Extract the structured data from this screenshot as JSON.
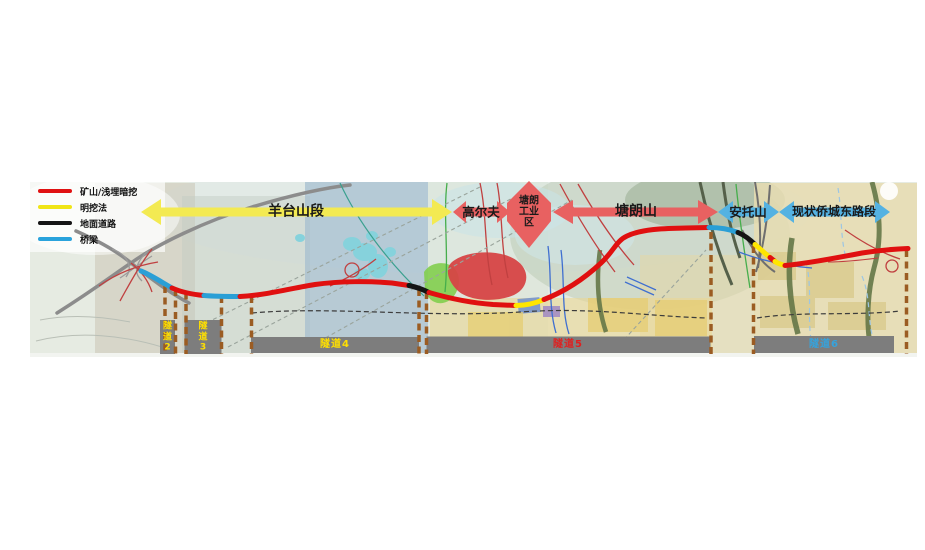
{
  "legend": {
    "items": [
      {
        "id": "mining",
        "label": "矿山/浅埋暗挖",
        "color": "#e01212"
      },
      {
        "id": "opencut",
        "label": "明挖法",
        "color": "#f0e516"
      },
      {
        "id": "ground",
        "label": "地面道路",
        "color": "#141414"
      },
      {
        "id": "bridge",
        "label": "桥梁",
        "color": "#2aa3dc"
      }
    ]
  },
  "sections": [
    {
      "id": "yangtaishan",
      "label": "羊台山段",
      "arrow_color": "#f3ea52",
      "shape": "double-arrow"
    },
    {
      "id": "golf",
      "label": "高尔夫",
      "arrow_color": "#e86161",
      "shape": "double-arrow"
    },
    {
      "id": "tanglang-industrial",
      "lines": [
        "塘朗",
        "工业",
        "区"
      ],
      "arrow_color": "#e86161",
      "shape": "diamond"
    },
    {
      "id": "tanglangshan",
      "label": "塘朗山",
      "arrow_color": "#e86161",
      "shape": "double-arrow"
    },
    {
      "id": "antuoshan",
      "label": "安托山",
      "arrow_color": "#54b2e2",
      "shape": "double-arrow"
    },
    {
      "id": "qiaocheng-east-road",
      "label": "现状侨城东路段",
      "arrow_color": "#54b2e2",
      "shape": "double-arrow"
    }
  ],
  "tunnels": [
    {
      "id": "tunnel-2",
      "label": "隧道2",
      "text_color": "#ffe000"
    },
    {
      "id": "tunnel-3",
      "label": "隧道3",
      "text_color": "#ffe000"
    },
    {
      "id": "tunnel-4",
      "label": "隧道4",
      "text_color": "#ffe000"
    },
    {
      "id": "tunnel-5",
      "label": "隧道5",
      "text_color": "#e02020"
    },
    {
      "id": "tunnel-6",
      "label": "隧道6",
      "text_color": "#35a3dd"
    }
  ],
  "route": {
    "segment_types": [
      "bridge",
      "mining",
      "bridge",
      "mining",
      "ground",
      "mining",
      "opencut",
      "mining",
      "bridge",
      "ground",
      "opencut",
      "mining",
      "opencut",
      "mining"
    ],
    "colors": {
      "mining": "#e01010",
      "opencut": "#ffe600",
      "ground": "#141414",
      "bridge": "#2a9fd6"
    }
  }
}
